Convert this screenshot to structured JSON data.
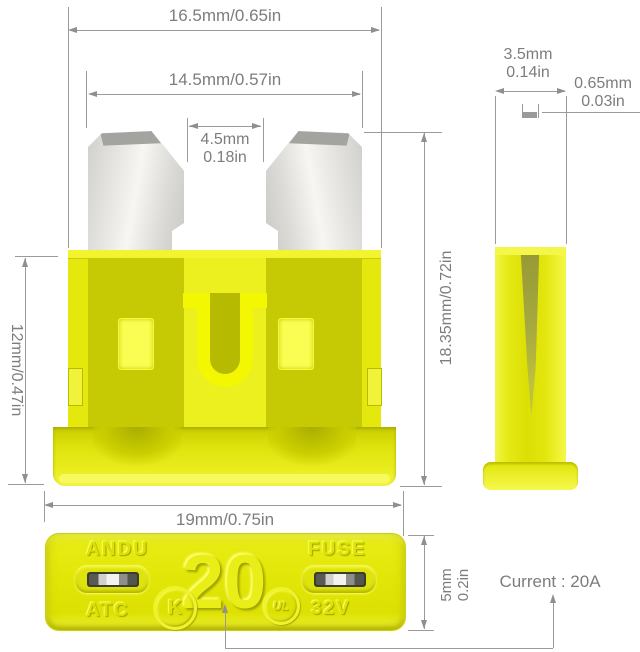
{
  "front_view": {
    "dim_top_width": "16.5mm/0.65in",
    "dim_blade_span": "14.5mm/0.57in",
    "dim_blade_gap_mm": "4.5mm",
    "dim_blade_gap_in": "0.18in",
    "dim_body_height": "12mm/0.47in",
    "dim_total_height": "18.35mm/0.72in",
    "dim_base_width": "19mm/0.75in"
  },
  "side_view": {
    "dim_width_mm": "3.5mm",
    "dim_width_in": "0.14in",
    "dim_blade_thickness_mm": "0.65mm",
    "dim_blade_thickness_in": "0.03in"
  },
  "top_view": {
    "dim_thickness_mm": "5mm",
    "dim_thickness_in": "0.2in",
    "brand": "ANDU",
    "label": "FUSE",
    "rating": "20",
    "series": "ATC",
    "voltage": "32V",
    "cert_left_glyph": "K",
    "cert_right_glyph": "UL"
  },
  "annotation": {
    "current": "Current : 20A"
  },
  "colors": {
    "fuse_yellow": "#e4e80d",
    "fuse_yellow_bright": "#f3f702",
    "fuse_yellow_dark": "#c6ca04",
    "blade_silver": "#e5e5e1",
    "dimension_gray": "#7d7d7d"
  }
}
